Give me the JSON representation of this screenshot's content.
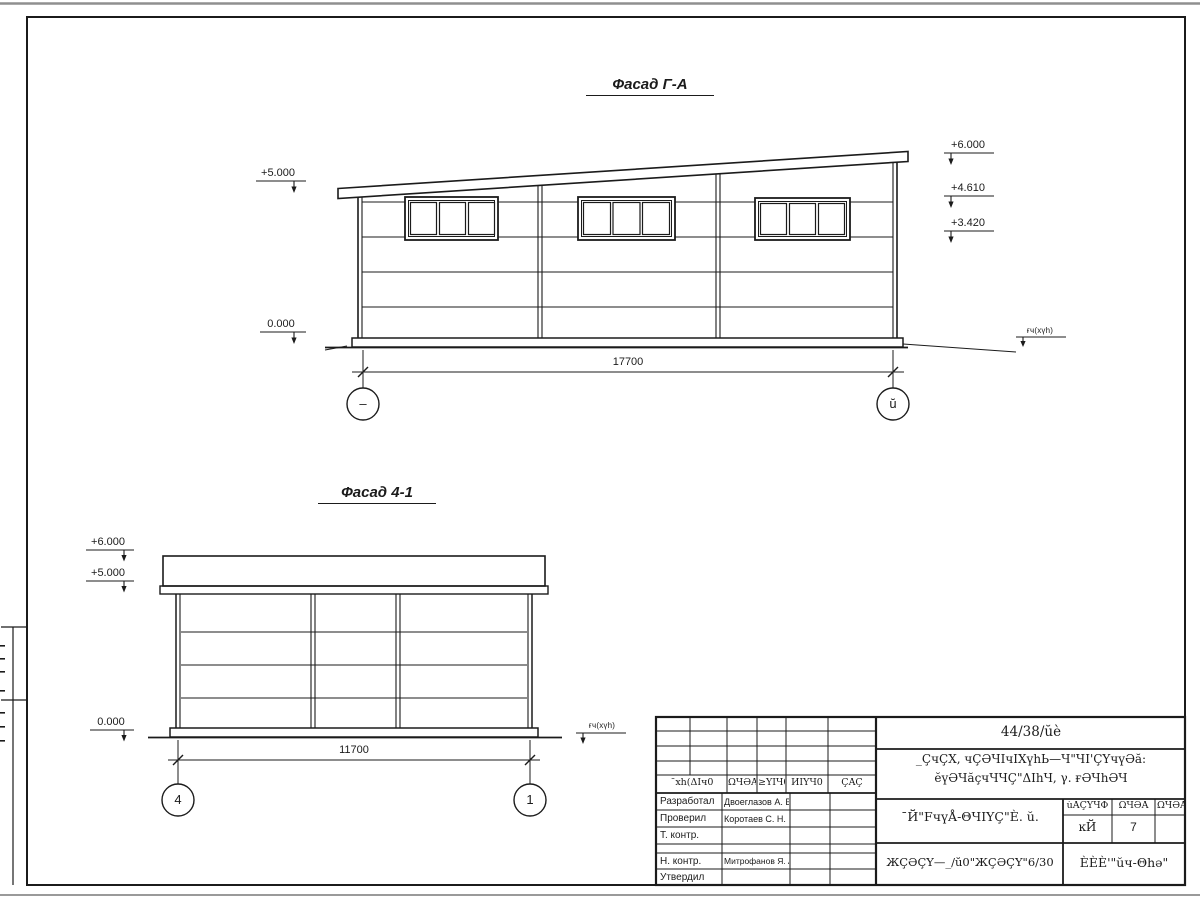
{
  "facade1": {
    "title": "Фасад Г-А",
    "elev_left_top": "+5.000",
    "elev_left_zero": "0.000",
    "elev_right_top": "+6.000",
    "elev_right_mid": "+4.610",
    "elev_right_low": "+3.420",
    "ground_label": "ғч(xүh)",
    "dimension": "17700",
    "axis_left": "–",
    "axis_right": "ŭ"
  },
  "facade2": {
    "title": "Фасад 4-1",
    "elev_top": "+6.000",
    "elev_mid": "+5.000",
    "elev_zero": "0.000",
    "ground_label": "ғч(xүh)",
    "dimension": "11700",
    "axis_left": "4",
    "axis_right": "1"
  },
  "stamp": {
    "doc_number": "44/38/ŭè",
    "project_title_line1": "_ÇчÇХ, чÇӘЧIчIХүhЬ—Ч\"ЧI'ÇҮчүӘă:",
    "project_title_line2": "ӗүӘЧăçчЧЧÇ\"ΔIhЧ, γ. ғӘЧhӘЧ",
    "drawing_name": "¯Й\"FчүÅ-ΘЧIҮÇ\"È. ŭ.",
    "code_label": "ЖÇӘÇҮ—_/ŭ0\"ЖÇӘÇҮ\"6/30",
    "company": "ÈÈÈ'\"ŭч-Θhә\"",
    "header_cells": [
      "¯хh(ΔIч0",
      "ΩЧӘÅ",
      "≥ΥΙЧ0",
      "ЙIҮЧ0",
      "ÇÅÇ"
    ],
    "stage_headers": [
      "ùÅÇҮЧΦ",
      "ΩЧӘÅ",
      "ΩЧӘÅΙΥ"
    ],
    "stage_values": [
      "ĸЙ",
      "7"
    ],
    "rows": [
      {
        "role": "Разработал",
        "name": "Двоеглазов А. В."
      },
      {
        "role": "Проверил",
        "name": "Коротаев С. Н."
      },
      {
        "role": "Т. контр.",
        "name": ""
      },
      {
        "role": "",
        "name": ""
      },
      {
        "role": "Н. контр.",
        "name": "Митрофанов Я. А."
      },
      {
        "role": "Утвердил",
        "name": ""
      }
    ]
  }
}
